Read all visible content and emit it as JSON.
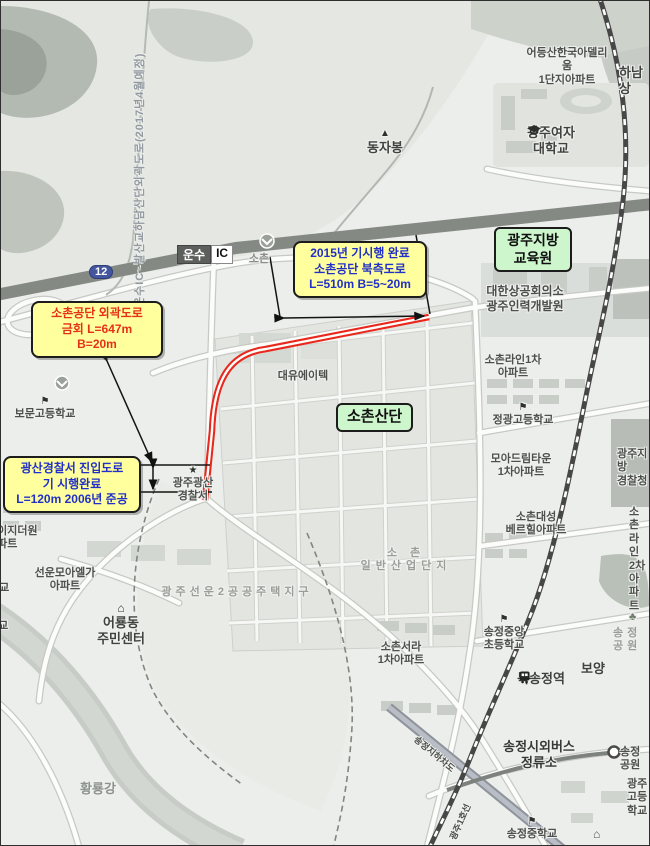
{
  "colors": {
    "map_bg": "#eceeeb",
    "highlight_route": "#e8281c",
    "note_bg": "#ffff9d",
    "note_blue": "#2230c9",
    "note_red": "#e63119",
    "green_box_bg": "#cdf6cc",
    "highway": "#858984",
    "railway": "#474747",
    "river": "#c7ccc6"
  },
  "icons": {
    "mountain": "▲",
    "school": "⚑",
    "house": "⌂",
    "police": "★",
    "tree": "♣"
  },
  "planned_road": {
    "label": "운수IC~발산교하남산단외곽도로(2017년4월예정)"
  },
  "highway": {
    "name": "운수",
    "ic": "IC",
    "route_shield": "12"
  },
  "annotation_boxes": {
    "north_road": {
      "lines": [
        "2015년 기시행 완료",
        "소촌공단 북측도로",
        "L=510m B=5~20m"
      ],
      "text_color": "#2230c9"
    },
    "outer_road": {
      "lines": [
        "소촌공단 외곽도로",
        "금회 L=647m",
        "B=20m"
      ],
      "text_color": "#e63119"
    },
    "access_road": {
      "lines": [
        "광산경찰서 진입도로",
        "기 시행완료",
        "L=120m 2006년 준공"
      ],
      "text_color": "#2230c9"
    }
  },
  "highlight_boxes": {
    "education": {
      "text": "광주지방\n교육원"
    },
    "sochon_sandan": {
      "text": "소촌산단"
    }
  },
  "labels": {
    "adellium": {
      "text": "어등산한국아델리움\n1단지아파트"
    },
    "hanam": {
      "text": "하남상"
    },
    "womens_univ": {
      "text": "광주여자\n대학교"
    },
    "dongjabong": {
      "text": "동자봉"
    },
    "kcci": {
      "text": "대한상공회의소\n광주인력개발원"
    },
    "sochon_line1": {
      "text": "소촌라인1차\n아파트"
    },
    "jeonggwang_hs": {
      "text": "정광고등학교"
    },
    "moa_dream": {
      "text": "모아드림타운\n1차아파트"
    },
    "gj_police_hq": {
      "text": "광주지방\n경찰청"
    },
    "sochon_daesung": {
      "text": "소촌대성\n베르힐아파트"
    },
    "sochon_line2": {
      "text": "소촌라인\n2차아파트"
    },
    "daeyou": {
      "text": "대유에이텍"
    },
    "bomun_hs": {
      "text": "보문고등학교"
    },
    "police_station": {
      "text": "광주광산\n경찰서"
    },
    "ejideowon": {
      "text": "구이지더원\n아파트"
    },
    "sunun_moa": {
      "text": "선운모아엘가\n아파트"
    },
    "hakgyo_clip": {
      "text": "학교"
    },
    "gyo_clip": {
      "text": "학교"
    },
    "eoryong": {
      "text": "어룡동\n주민센터"
    },
    "seonun2": {
      "text": "광주선운2공공주택지구"
    },
    "sochon_ind": {
      "text": "소 촌\n일반산업단지"
    },
    "sochon_small": {
      "text": "소촌"
    },
    "sochon_seora": {
      "text": "소촌서라\n1차아파트"
    },
    "songjeong_jungang": {
      "text": "송정중앙\n초등학교"
    },
    "boyang": {
      "text": "보양"
    },
    "buksongjeong": {
      "text": "북송정역"
    },
    "songjeong_park": {
      "text": "송정공원"
    },
    "bus_terminal": {
      "text": "송정시외버스\n정류소"
    },
    "park_station": {
      "text": "송정공원"
    },
    "gwangju_hs": {
      "text": "광주\n고등학교"
    },
    "songjeong_ms": {
      "text": "송정중학교"
    },
    "hwangnyong": {
      "text": "황룡강"
    },
    "underpass_road": {
      "text": "송정지하차도"
    },
    "subway_line1": {
      "text": "광주1호선"
    }
  }
}
